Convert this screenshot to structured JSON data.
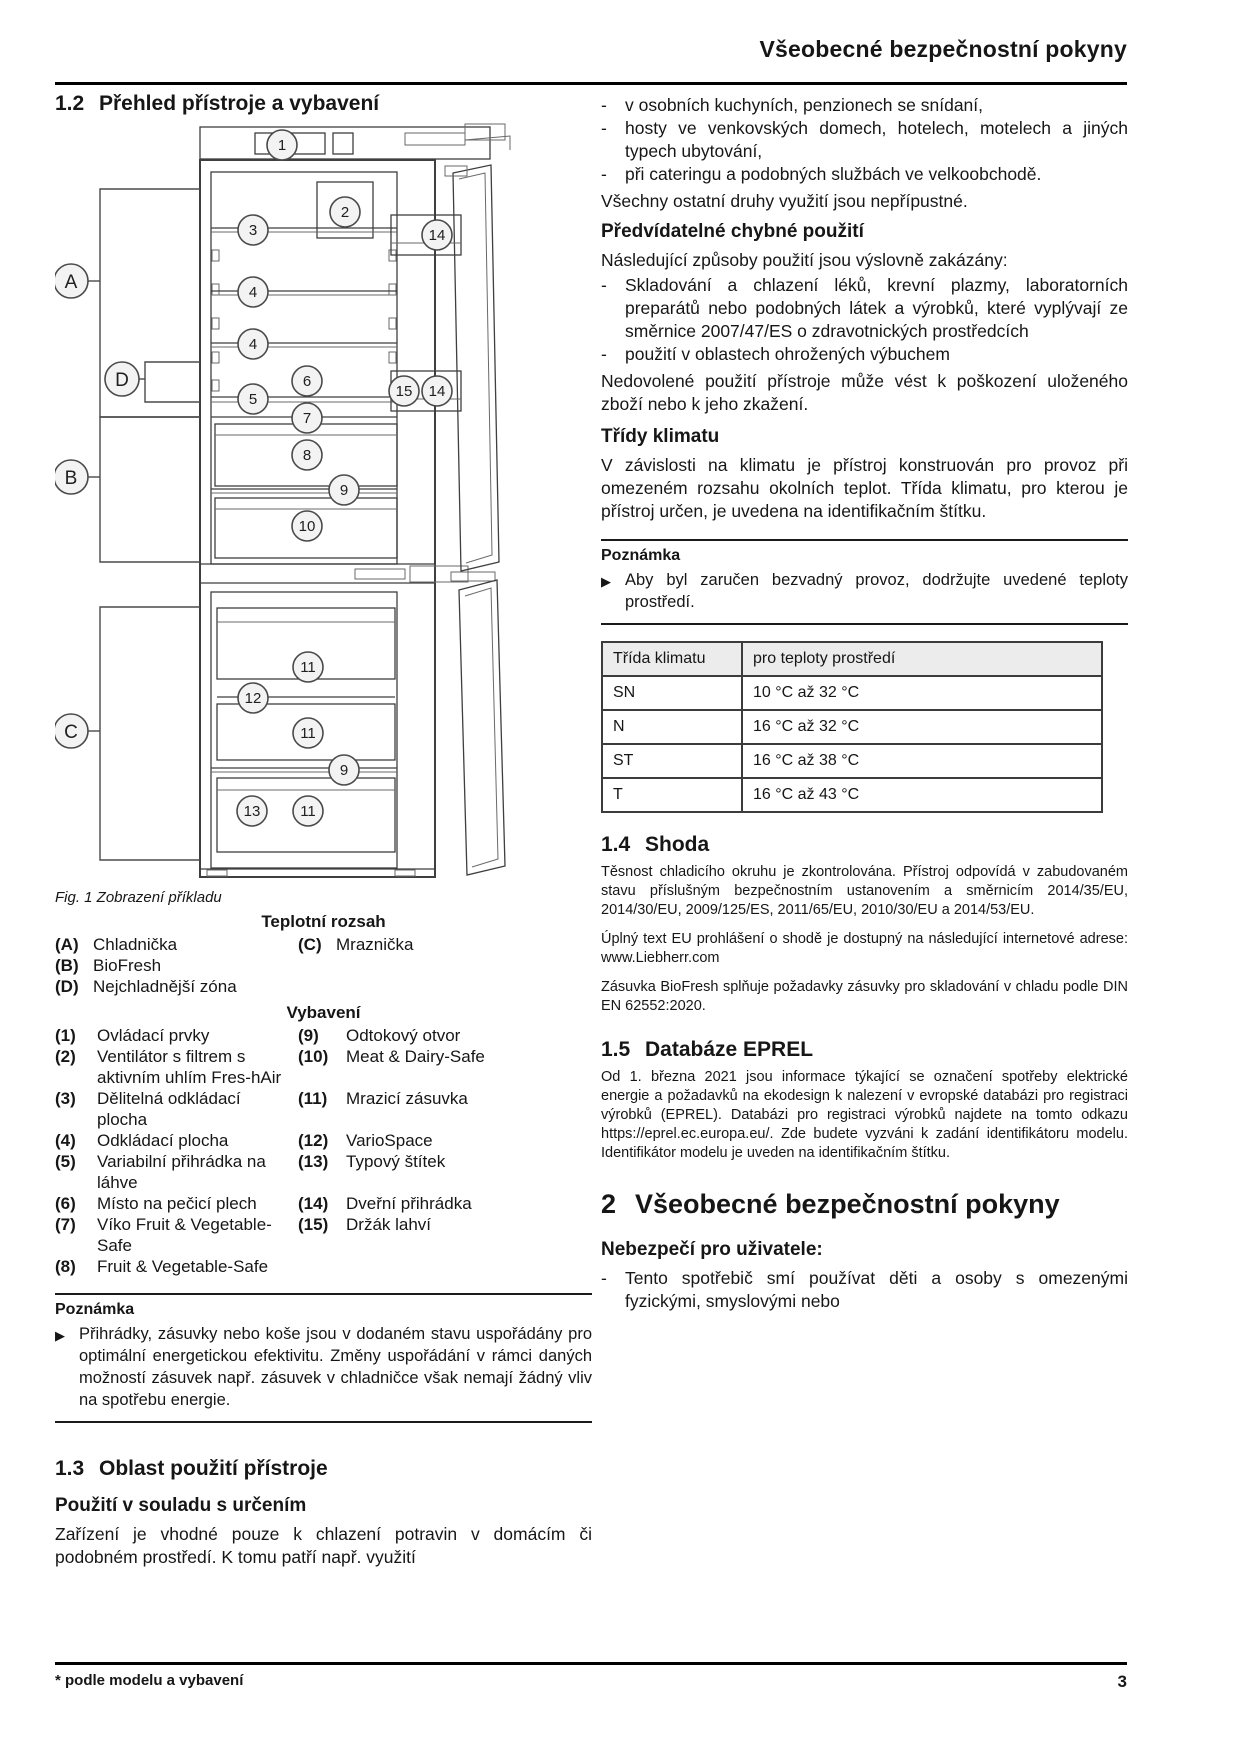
{
  "header": {
    "title": "Všeobecné bezpečnostní pokyny"
  },
  "marks": {
    "dash": "-",
    "arrow": "▶"
  },
  "colors": {
    "text": "#161616",
    "rule": "#000000",
    "table_header_bg": "#ececec",
    "callout_fill": "#f3f3f3"
  },
  "left": {
    "s12": {
      "num": "1.2",
      "title": "Přehled přístroje a vybavení"
    },
    "figure": {
      "caption": "Fig. 1 Zobrazení příkladu",
      "letters": [
        "A",
        "B",
        "C",
        "D"
      ],
      "numbers": [
        "1",
        "2",
        "3",
        "14",
        "4",
        "4",
        "6",
        "5",
        "15",
        "14",
        "7",
        "8",
        "9",
        "10",
        "11",
        "12",
        "11",
        "9",
        "13",
        "11"
      ]
    },
    "temp": {
      "heading": "Teplotní rozsah",
      "rows": [
        {
          "lk": "(A)",
          "lv": "Chladnička",
          "rk": "(C)",
          "rv": "Mraznička"
        },
        {
          "lk": "(B)",
          "lv": "BioFresh",
          "rk": "",
          "rv": ""
        },
        {
          "lk": "(D)",
          "lv": "Nejchladnější zóna",
          "rk": "",
          "rv": ""
        }
      ]
    },
    "equip": {
      "heading": "Vybavení",
      "rows": [
        {
          "lk": "(1)",
          "lv": "Ovládací prvky",
          "rk": "(9)",
          "rv": "Odtokový otvor"
        },
        {
          "lk": "(2)",
          "lv": "Ventilátor s filtrem s aktivním uhlím Fres-hAir",
          "rk": "(10)",
          "rv": "Meat & Dairy-Safe"
        },
        {
          "lk": "(3)",
          "lv": "Dělitelná odkládací plocha",
          "rk": "(11)",
          "rv": "Mrazicí zásuvka"
        },
        {
          "lk": "(4)",
          "lv": "Odkládací plocha",
          "rk": "(12)",
          "rv": "VarioSpace"
        },
        {
          "lk": "(5)",
          "lv": "Variabilní přihrádka na láhve",
          "rk": "(13)",
          "rv": "Typový štítek"
        },
        {
          "lk": "(6)",
          "lv": "Místo na pečicí plech",
          "rk": "(14)",
          "rv": "Dveřní přihrádka"
        },
        {
          "lk": "(7)",
          "lv": "Víko Fruit & Vegetable-Safe",
          "rk": "(15)",
          "rv": "Držák lahví"
        },
        {
          "lk": "(8)",
          "lv": "Fruit & Vegetable-Safe",
          "rk": "",
          "rv": ""
        }
      ]
    },
    "note1": {
      "heading": "Poznámka",
      "text": "Přihrádky, zásuvky nebo koše jsou v dodaném stavu uspořádány pro optimální energetickou efektivitu. Změny uspořádání v rámci daných možností zásuvek např. zásuvek v chladničce však nemají žádný vliv na spotřebu energie."
    },
    "s13": {
      "num": "1.3",
      "title": "Oblast použití přístroje"
    },
    "s13_sub": "Použití v souladu s určením",
    "s13_par": "Zařízení je vhodné pouze k chlazení potravin v domácím či podobném prostředí. K tomu patří např. využití"
  },
  "right": {
    "intro_bullets": [
      "v osobních kuchyních, penzionech se snídaní,",
      "hosty ve venkovských domech, hotelech, motelech a jiných typech ubytování,",
      "při cateringu a podobných službách ve velkoobchodě."
    ],
    "par1": "Všechny ostatní druhy využití jsou nepřípustné.",
    "sub1": "Předvídatelné chybné použití",
    "par2": "Následující způsoby použití jsou výslovně zakázány:",
    "bullets2": [
      "Skladování a chlazení léků, krevní plazmy, laboratorních preparátů nebo podobných látek a výrobků, které vyplývají ze směrnice 2007/47/ES o zdravotnických prostředcích",
      "použití v oblastech ohrožených výbuchem"
    ],
    "par3": "Nedovolené použití přístroje může vést k poškození uloženého zboží nebo k jeho zkažení.",
    "sub2": "Třídy klimatu",
    "par4": "V závislosti na klimatu je přístroj konstruován pro provoz při omezeném rozsahu okolních teplot. Třída klimatu, pro kterou je přístroj určen, je uvedena na identifikačním štítku.",
    "note2": {
      "heading": "Poznámka",
      "text": "Aby byl zaručen bezvadný provoz, dodržujte uvedené teploty prostředí."
    },
    "table": {
      "headers": [
        "Třída klimatu",
        "pro teploty prostředí"
      ],
      "rows": [
        {
          "c1": "SN",
          "c2": "10 °C až 32 °C"
        },
        {
          "c1": "N",
          "c2": "16 °C až 32 °C"
        },
        {
          "c1": "ST",
          "c2": "16 °C až 38 °C"
        },
        {
          "c1": "T",
          "c2": "16 °C až 43 °C"
        }
      ]
    },
    "s14": {
      "num": "1.4",
      "title": "Shoda"
    },
    "s14_par1": "Těsnost chladicího okruhu je zkontrolována. Přístroj odpovídá v zabudovaném stavu příslušným bezpečnostním ustanovením a směrnicím 2014/35/EU, 2014/30/EU, 2009/125/ES, 2011/65/EU, 2010/30/EU a 2014/53/EU.",
    "s14_par2_pre": "Úplný text EU prohlášení o shodě je dostupný na následující internetové adrese: ",
    "s14_par2_url": "www.Liebherr.com",
    "s14_par3": "Zásuvka BioFresh splňuje požadavky zásuvky pro skladování v chladu podle DIN EN 62552:2020.",
    "s15": {
      "num": "1.5",
      "title": "Databáze EPREL"
    },
    "s15_par_a": "Od 1. března 2021 jsou informace týkající se označení spotřeby elektrické energie a požadavků na ekodesign k nalezení v evropské databázi pro registraci výrobků (EPREL). Databázi pro registraci výrobků najdete na tomto odkazu ",
    "s15_par_url": "https://eprel.ec.europa.eu/",
    "s15_par_b": ". Zde budete vyzváni k zadání identifikátoru modelu. Identifikátor modelu je uveden na identifikačním štítku.",
    "s2": {
      "num": "2",
      "title": "Všeobecné bezpečnostní pokyny"
    },
    "s2_sub": "Nebezpečí pro uživatele:",
    "s2_bullet": "Tento spotřebič smí používat děti a osoby s omezenými fyzickými, smyslovými nebo"
  },
  "footer": {
    "note": "* podle modelu a vybavení",
    "page": "3"
  }
}
